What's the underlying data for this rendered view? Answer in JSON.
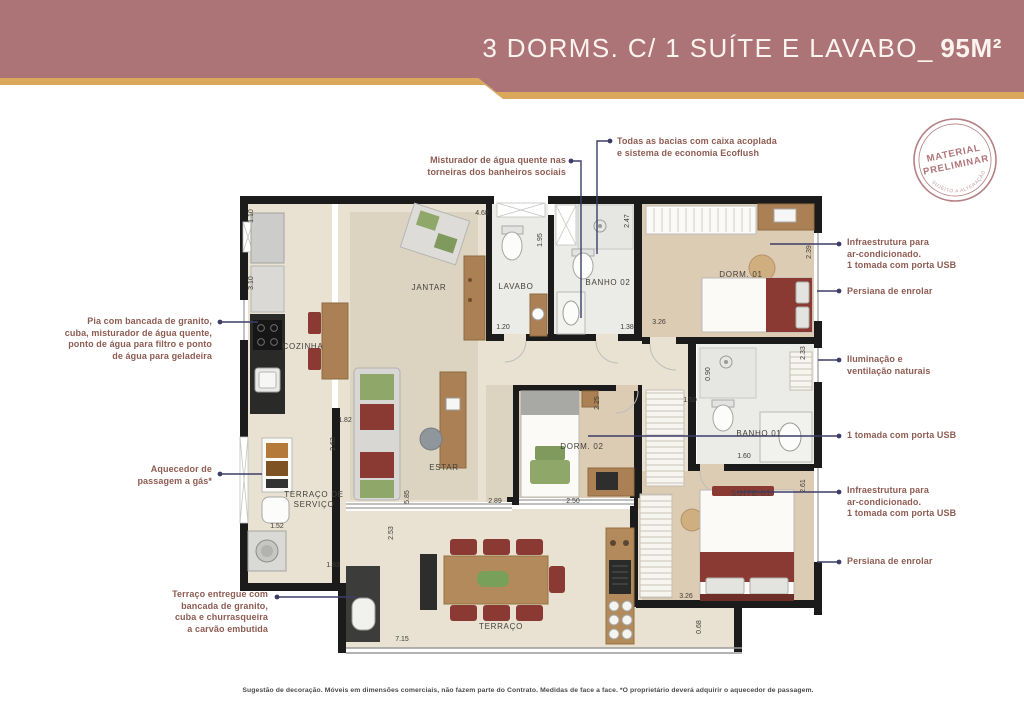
{
  "header": {
    "title_main": "3 DORMS. C/ 1 SUÍTE E LAVABO_",
    "title_area": "95M²"
  },
  "stamp": {
    "line1": "MATERIAL",
    "line2": "PRELIMINAR",
    "arc_text": "SUJEITO A ALTERAÇÃO"
  },
  "annotations": {
    "left": [
      {
        "id": "pia",
        "text": "Pia com bancada de granito,\ncuba, misturador de água quente,\nponto de água para filtro e ponto\nde água para geladeira"
      },
      {
        "id": "aquecedor",
        "text": "Aquecedor de\npassagem a gás*"
      },
      {
        "id": "terraco_entregue",
        "text": "Terraço entregue com\nbancada de granito,\ncuba e churrasqueira\na carvão embutida"
      }
    ],
    "top": [
      {
        "id": "misturador",
        "text": "Misturador de água quente nas\ntorneiras dos banheiros sociais"
      },
      {
        "id": "bacias",
        "text": "Todas as bacias com caixa acoplada\ne sistema de economia Ecoflush"
      }
    ],
    "right": [
      {
        "id": "infra_ac_1",
        "text": "Infraestrutura para\nar-condicionado.\n1 tomada com porta USB"
      },
      {
        "id": "persiana_1",
        "text": "Persiana de enrolar"
      },
      {
        "id": "iluminacao",
        "text": "Iluminação e\nventilação naturais"
      },
      {
        "id": "tomada_usb",
        "text": "1 tomada com porta USB"
      },
      {
        "id": "infra_ac_2",
        "text": "Infraestrutura para\nar-condicionado.\n1 tomada com porta USB"
      },
      {
        "id": "persiana_2",
        "text": "Persiana de enrolar"
      }
    ]
  },
  "plan": {
    "rooms": {
      "cozinha": "COZINHA",
      "jantar": "JANTAR",
      "lavabo": "LAVABO",
      "banho02": "BANHO 02",
      "dorm01": "DORM. 01",
      "estar": "ESTAR",
      "dorm02": "DORM. 02",
      "banho01": "BANHO 01",
      "suite": "SUÍTE 01",
      "servico": "TERRAÇO DE\nSERVIÇO",
      "terraco": "TERRAÇO"
    },
    "dims": [
      "1.10",
      "3.10",
      "4.68",
      "1.95",
      "2.47",
      "1.20",
      "1.38",
      "3.26",
      "2.39",
      "2.33",
      "0.90",
      "1.50",
      "2.25",
      "1.82",
      "2.63",
      "5.85",
      "2.89",
      "2.50",
      "1.60",
      "2.61",
      "1.52",
      "1.83",
      "2.53",
      "7.15",
      "3.26",
      "0.68"
    ]
  },
  "footer": {
    "disclaimer": "Sugestão de decoração. Móveis em dimensões comerciais, não fazem parte do Contrato. Medidas de face a face. *O proprietário deverá adquirir o aquecedor de passagem."
  },
  "colors": {
    "band": "#ad7477",
    "gold": "#dba75a",
    "annotation_text": "#8e5c52",
    "leader_line": "#3d3d68",
    "wall": "#1b1b1b",
    "floor": "#e9e2d3",
    "floor_rug": "#dcd4c1",
    "floor_bedroom": "#ddccb4",
    "floor_bath": "#ebebe8",
    "wood": "#ab8054",
    "chair_red": "#8a3a32",
    "stamp": "#b07579"
  }
}
